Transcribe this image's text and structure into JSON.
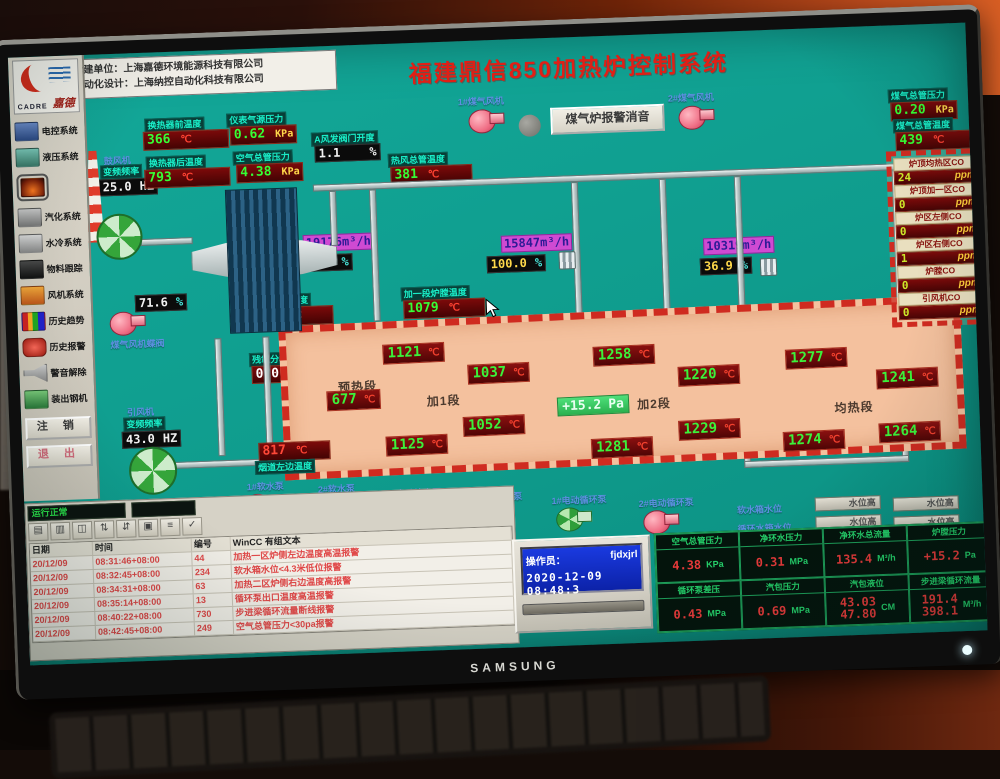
{
  "photo": {
    "brand": "SAMSUNG"
  },
  "header": {
    "builder_line1": "承建单位：上海嘉德环境能源科技有限公司",
    "builder_line2": "自动化设计：上海纳控自动化科技有限公司",
    "title": "福建鼎信850加热炉控制系统"
  },
  "sidebar": {
    "logo_text": "CADRE",
    "logo_sub": "嘉德",
    "items": [
      {
        "label": "电控系统"
      },
      {
        "label": "液压系统"
      },
      {
        "label": ""
      },
      {
        "label": "汽化系统"
      },
      {
        "label": "水冷系统"
      },
      {
        "label": "物料跟踪"
      },
      {
        "label": "风机系统"
      },
      {
        "label": "历史趋势"
      },
      {
        "label": "历史报警"
      },
      {
        "label": "警音解除"
      },
      {
        "label": "装出钢机"
      }
    ],
    "logout": "注 销",
    "exit": "退 出",
    "status": "运行正常"
  },
  "mimic": {
    "sensors": {
      "hx_front": {
        "label": "换热器前温度",
        "value": "366",
        "unit": "℃"
      },
      "hx_back": {
        "label": "换热器后温度",
        "value": "793",
        "unit": "℃"
      },
      "inst_air": {
        "label": "仪表气源压力",
        "value": "0.62",
        "unit": "KPa"
      },
      "air_main": {
        "label": "空气总管压力",
        "value": "4.38",
        "unit": "KPa"
      },
      "a_valve": {
        "label": "A风发阀门开度",
        "value": "1.1",
        "unit": "%"
      },
      "hot_air": {
        "label": "热风总管温度",
        "value": "381",
        "unit": "℃"
      },
      "gas_press": {
        "label": "煤气总管压力",
        "value": "0.20",
        "unit": "KPa"
      },
      "gas_temp": {
        "label": "煤气总管温度",
        "value": "439",
        "unit": "℃"
      },
      "flue_right": {
        "label": "烟道右边温度",
        "value": "848",
        "unit": "℃"
      },
      "zone1": {
        "label": "加一段炉膛温度",
        "value": "1079",
        "unit": "℃"
      },
      "o2": {
        "label": "残氧分析仪",
        "value": "0.0",
        "unit": ""
      },
      "flue_left": {
        "label": "烟道左边温度",
        "value": "817",
        "unit": "℃"
      },
      "blower": {
        "label": "鼓风机",
        "freq_label": "变频频率",
        "freq": "25.0",
        "unit": "HZ"
      },
      "id_fan": {
        "label": "引风机",
        "freq_label": "变频频率",
        "freq": "43.0",
        "unit": "HZ"
      },
      "gas_valve": {
        "label": "煤气风机蝶阀",
        "value": "71.6",
        "unit": "%"
      }
    },
    "flows": [
      {
        "flow": "19176m³/h",
        "pct": "97.9",
        "unit": "%"
      },
      {
        "flow": "15847m³/h",
        "pct": "100.0",
        "unit": "%"
      },
      {
        "flow": "10319m³/h",
        "pct": "36.9",
        "unit": "%"
      }
    ],
    "top_pumps": {
      "p1": "1#煤气风机",
      "p2": "2#煤气风机"
    },
    "mute_button": "煤气炉报警消音",
    "co_panel": {
      "rows": [
        {
          "label": "炉顶均热区CO",
          "value": "24",
          "unit": "ppm"
        },
        {
          "label": "炉顶加一区CO",
          "value": "0",
          "unit": "ppm"
        },
        {
          "label": "炉区左侧CO",
          "value": "0",
          "unit": "ppm"
        },
        {
          "label": "炉区右侧CO",
          "value": "1",
          "unit": "ppm"
        },
        {
          "label": "炉膛CO",
          "value": "0",
          "unit": "ppm"
        },
        {
          "label": "引风机CO",
          "value": "0",
          "unit": "ppm"
        }
      ]
    },
    "furnace": {
      "sections": [
        "预热段",
        "加1段",
        "加2段",
        "均热段"
      ],
      "pressure": {
        "value": "+15.2",
        "unit": "Pa"
      },
      "temps": [
        {
          "value": "677",
          "unit": "℃"
        },
        {
          "value": "1121",
          "unit": "℃"
        },
        {
          "value": "1037",
          "unit": "℃"
        },
        {
          "value": "1258",
          "unit": "℃"
        },
        {
          "value": "1220",
          "unit": "℃"
        },
        {
          "value": "1277",
          "unit": "℃"
        },
        {
          "value": "1241",
          "unit": "℃"
        },
        {
          "value": "1052",
          "unit": "℃"
        },
        {
          "value": "1125",
          "unit": "℃"
        },
        {
          "value": "1281",
          "unit": "℃"
        },
        {
          "value": "1229",
          "unit": "℃"
        },
        {
          "value": "1264",
          "unit": "℃"
        },
        {
          "value": "1274",
          "unit": "℃"
        }
      ]
    },
    "bottom_pumps": [
      {
        "label": "1#软水泵"
      },
      {
        "label": "2#软水泵"
      },
      {
        "label": "1#电动补水泵"
      },
      {
        "label": "2#电动补水泵"
      },
      {
        "label": "1#电动循环泵"
      },
      {
        "label": "2#电动循环泵"
      }
    ],
    "water_levels": {
      "tank1": "软水箱水位",
      "tank2": "循环水箱水位",
      "indicator": "水位高"
    }
  },
  "alarms": {
    "headers": [
      "日期",
      "时间",
      "编号",
      "WinCC 有组文本"
    ],
    "rows": [
      {
        "date": "20/12/09",
        "time": "08:31:46+08:00",
        "no": "44",
        "text": "加热一区炉侧左边温度高温报警"
      },
      {
        "date": "20/12/09",
        "time": "08:32:45+08:00",
        "no": "234",
        "text": "软水箱水位<4.3米低位报警"
      },
      {
        "date": "20/12/09",
        "time": "08:34:31+08:00",
        "no": "63",
        "text": "加热二区炉侧右边温度高报警"
      },
      {
        "date": "20/12/09",
        "time": "08:35:14+08:00",
        "no": "13",
        "text": "循环泵出口温度高温报警"
      },
      {
        "date": "20/12/09",
        "time": "08:40:22+08:00",
        "no": "730",
        "text": "步进梁循环流量断线报警"
      },
      {
        "date": "20/12/09",
        "time": "08:42:45+08:00",
        "no": "249",
        "text": "空气总管压力<30pa报警"
      }
    ],
    "toolbar_glyphs": [
      "▤",
      "▥",
      "◫",
      "⇅",
      "⇵",
      "▣",
      "≡",
      "✓"
    ]
  },
  "operator": {
    "label": "操作员：",
    "name": "fjdxjrl",
    "datetime": "2020-12-09 08:48:3"
  },
  "bottom_grid": {
    "cells": [
      {
        "label": "空气总管压力",
        "value": "4.38",
        "unit": "KPa"
      },
      {
        "label": "净环水压力",
        "value": "0.31",
        "unit": "MPa"
      },
      {
        "label": "净环水总流量",
        "value": "135.4",
        "unit": "M³/h"
      },
      {
        "label": "炉膛压力",
        "value": "+15.2",
        "unit": "Pa"
      },
      {
        "label": "循环泵差压",
        "value": "0.43",
        "unit": "MPa"
      },
      {
        "label": "汽包压力",
        "value": "0.69",
        "unit": "MPa"
      },
      {
        "label": "汽包液位",
        "value": "43.03",
        "value2": "47.80",
        "unit": "CM"
      },
      {
        "label": "步进梁循环流量",
        "value": "191.4",
        "value2": "398.1",
        "unit": "M³/h"
      }
    ]
  }
}
